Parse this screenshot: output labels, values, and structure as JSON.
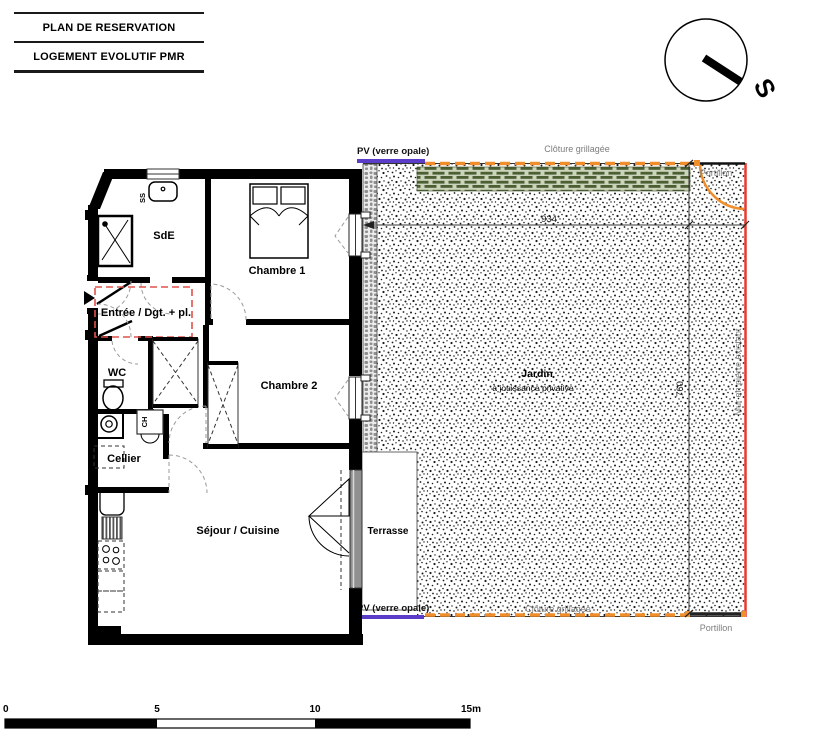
{
  "title_block": {
    "line1": "PLAN DE RESERVATION",
    "line2": "LOGEMENT EVOLUTIF PMR"
  },
  "compass": {
    "south_label": "S"
  },
  "rooms": {
    "sde": "SdE",
    "chambre1": "Chambre 1",
    "entree": "Entrée / Dgt. + pl.",
    "wc": "WC",
    "chambre2": "Chambre 2",
    "cellier": "Cellier",
    "sejour": "Séjour / Cuisine",
    "terrasse": "Terrasse",
    "jardin": "Jardin",
    "jardin_sub": "à jouissance privative"
  },
  "fixtures": {
    "ss": "SS",
    "ch": "CH"
  },
  "annotations": {
    "pv_top": "PV (verre opale)",
    "pv_bottom": "PV (verre opale)",
    "cloture_top": "Clôture grillagée",
    "cloture_bottom": "Clôture grillagée",
    "portillon_top": "Portillon",
    "portillon_bottom": "Portillon",
    "mur": "Mur en pierre existant"
  },
  "dimensions": {
    "garden_width": "934",
    "garden_height": "760"
  },
  "scale_ticks": [
    "0",
    "5",
    "10",
    "15m"
  ],
  "colors": {
    "pv_screen": "#5b3cc8",
    "fence_orange": "#ef8e2b",
    "plot_boundary_red": "#e8392f",
    "entry_zone_red": "#e0504a",
    "hedge_dark": "#4c5f33",
    "hedge_light": "#cbd4bb",
    "label_gray": "#7d7d7d"
  }
}
